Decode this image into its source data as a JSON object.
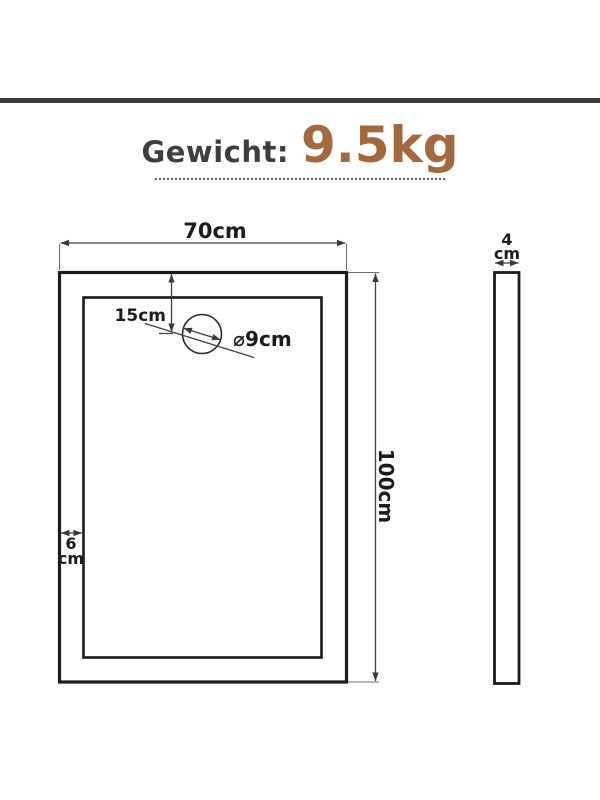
{
  "header": {
    "weight_label": "Gewicht:",
    "weight_value": "9.5kg"
  },
  "diagram": {
    "front_view": {
      "width_label": "70cm",
      "height_label": "100cm",
      "drain_offset_label": "15cm",
      "drain_diameter_label": "⌀9cm",
      "border_width_value": "6",
      "border_width_unit": "cm"
    },
    "side_view": {
      "thickness_value": "4",
      "thickness_unit": "cm"
    }
  },
  "colors": {
    "accent_brown": "#a5683d",
    "title_text": "#3d3d3d",
    "top_bar": "#3b3b3b",
    "drawing_line": "#1c1c1c"
  }
}
